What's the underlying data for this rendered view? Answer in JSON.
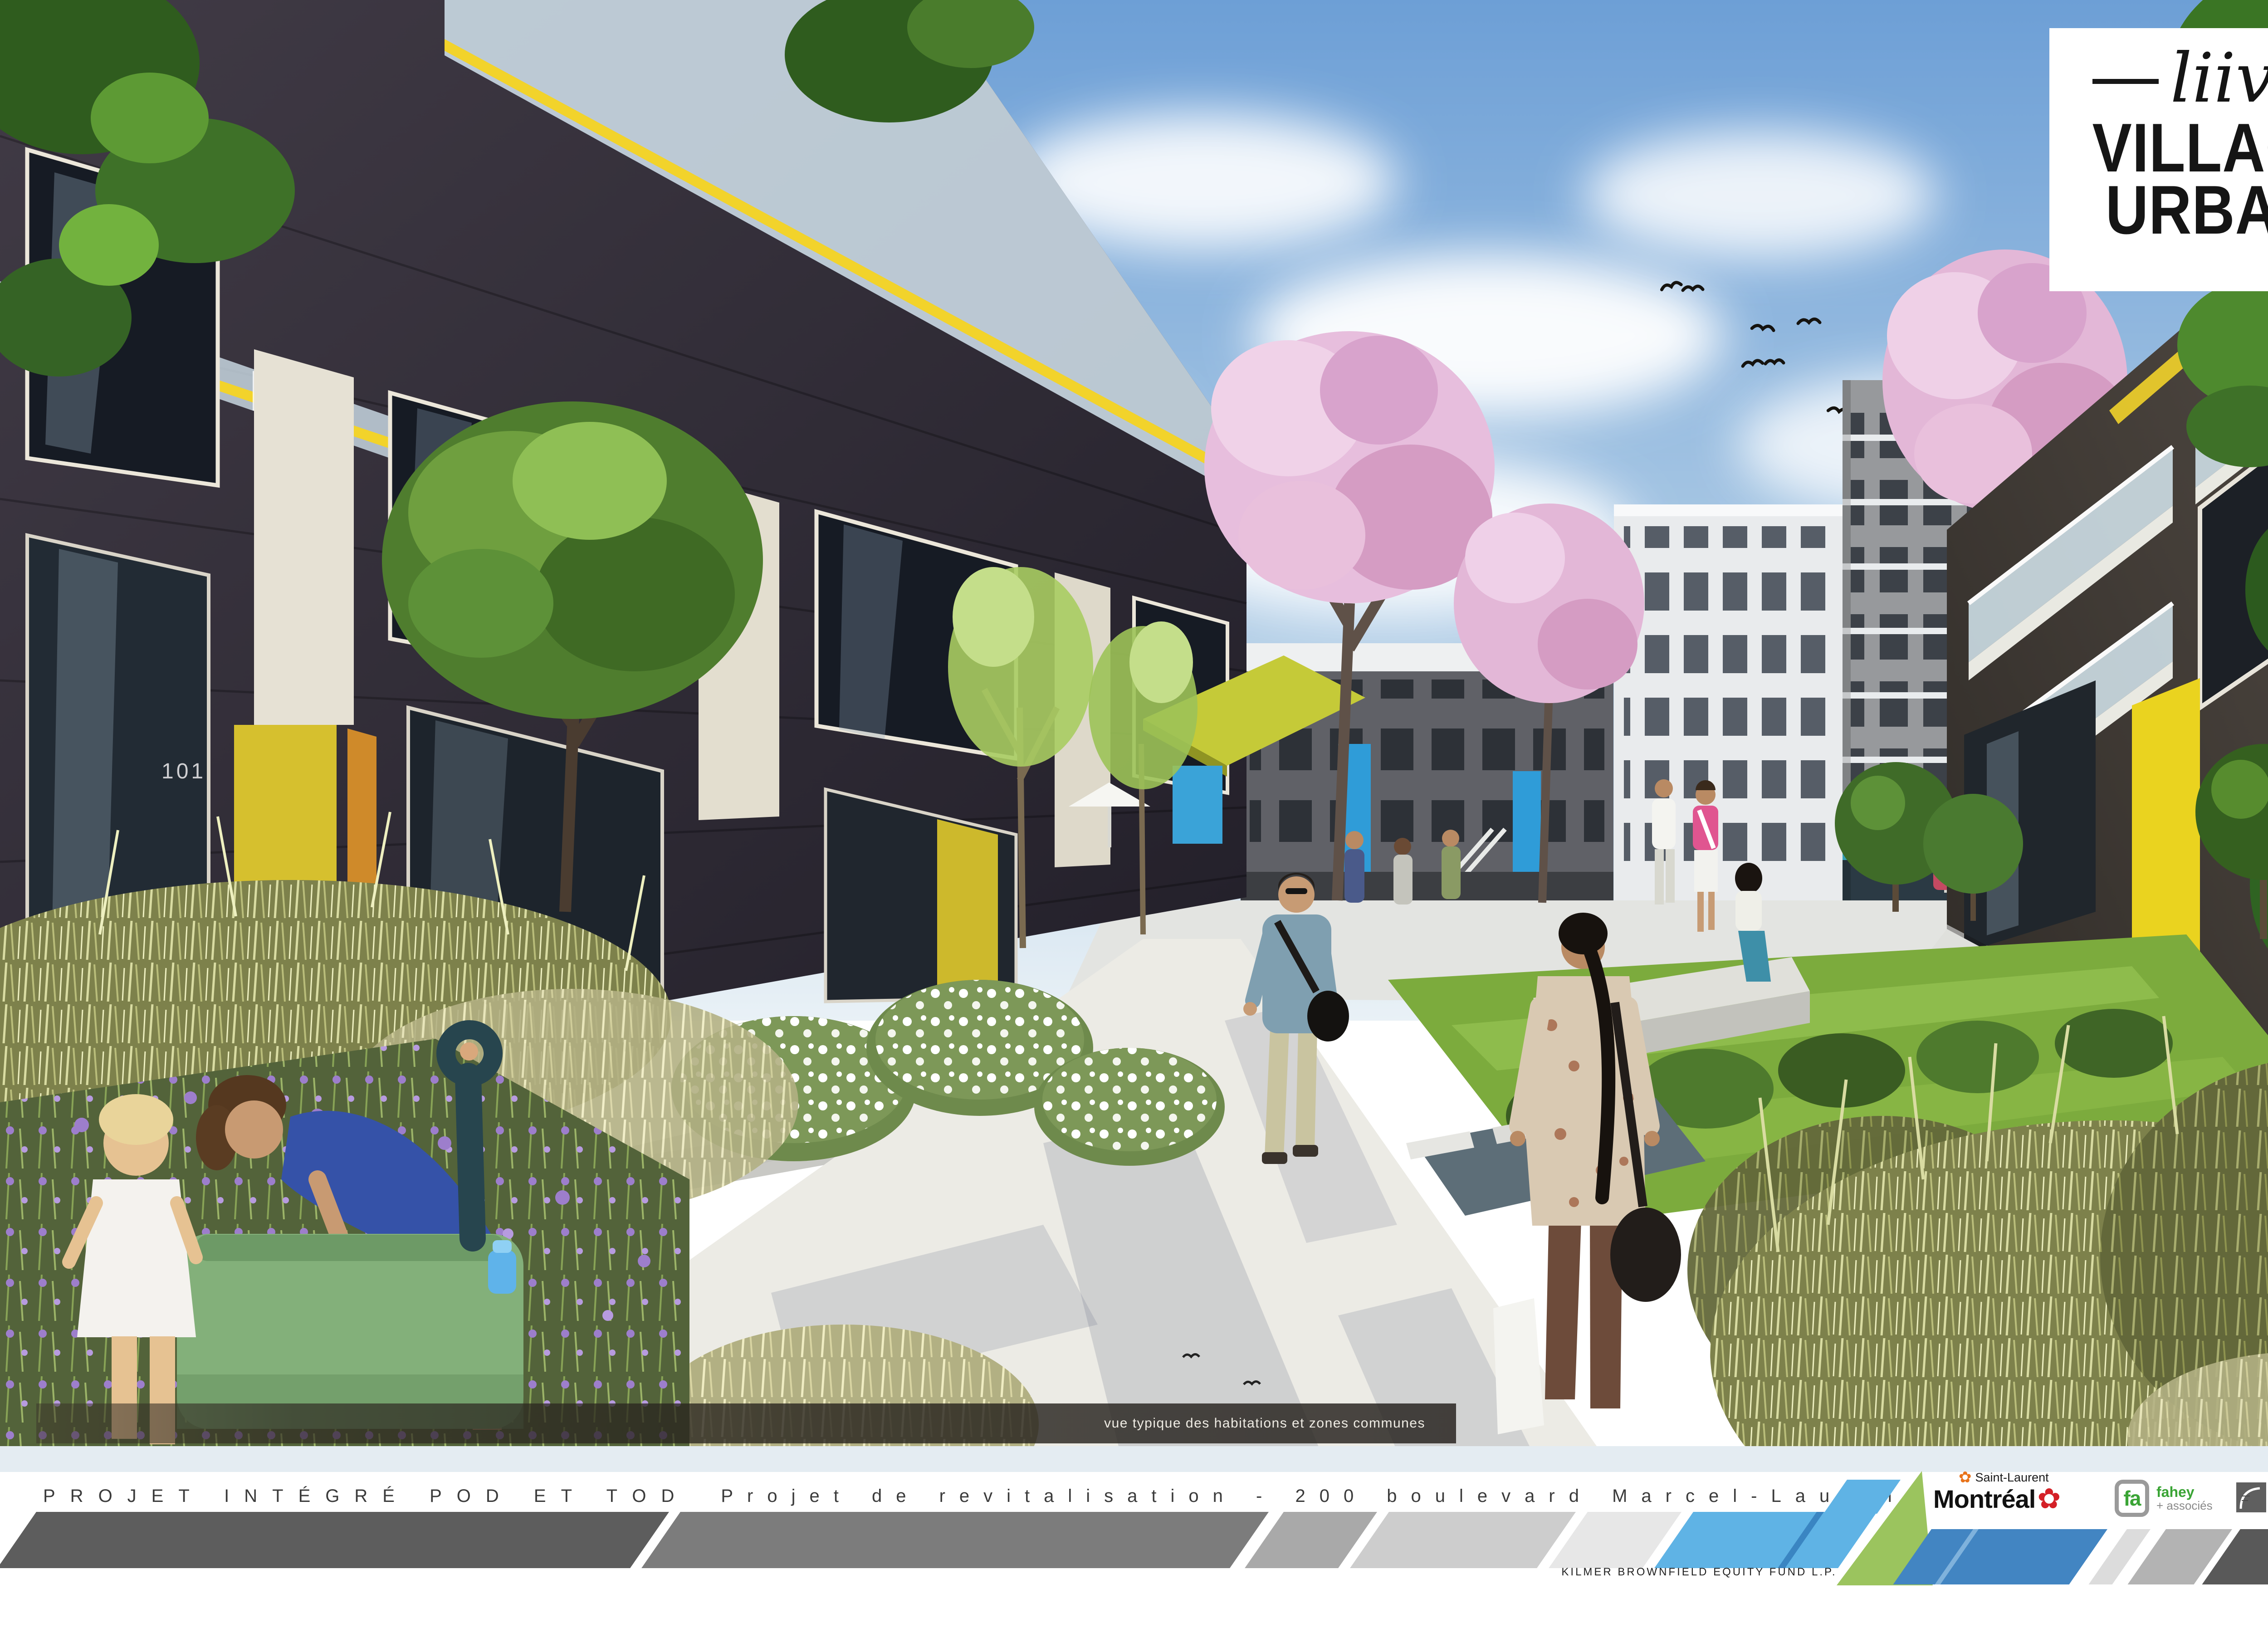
{
  "branding": {
    "script": "liiv",
    "line1": "VILLAGE",
    "line2": "URBAIN"
  },
  "image": {
    "caption": "vue typique des habitations et zones communes",
    "unit_101": "101",
    "unit_102": "102"
  },
  "footer": {
    "project_title": "PROJET INTÉGRÉ POD ET TOD",
    "project_subtitle": "Projet de revitalisation - 200 boulevard Marcel-Laurin",
    "fund": "KILMER BROWNFIELD EQUITY FUND L.P."
  },
  "partners": {
    "saint_laurent": {
      "line1": "Saint-Laurent",
      "line2": "Montréal"
    },
    "fahey": {
      "mark": "fa",
      "name": "fahey",
      "suffix": "+ associés"
    },
    "campanella": {
      "name": "CAMPANELLA & ASSOCIÉS",
      "tagline": "architecture + design"
    }
  },
  "colors": {
    "accent_yellow": "#f2d32b",
    "door_yellow": "#d6c02e",
    "stripe_dark_gray": "#5d5d5d",
    "stripe_blue_light": "#5fb3e5",
    "stripe_blue": "#4285c2",
    "stripe_green": "#9bc45e",
    "fahey_green": "#3aa435",
    "montreal_red": "#d42027",
    "saint_laurent_orange": "#e8731a",
    "teal_storefront": "#3fbcd4"
  }
}
